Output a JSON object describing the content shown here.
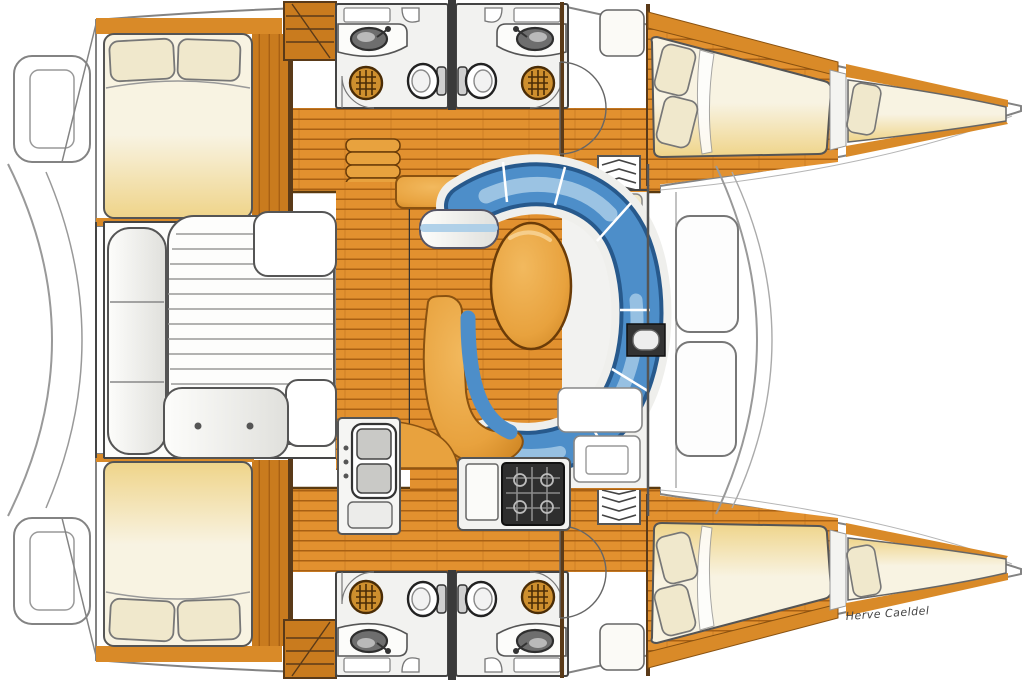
{
  "credit": {
    "artist_signature": "Herve Caeldel"
  },
  "palette": {
    "bg": "#FFFFFF",
    "wood_base": "#E2912F",
    "wood_gap": "#A86013",
    "wood_dark": "#C97B1E",
    "hull_wall": "#D98A28",
    "hull_wall_dark": "#8A5210",
    "wall_dark": "#4A3014",
    "outline": "#555555",
    "hull_stroke": "#838383",
    "bed_light": "#F8F3E2",
    "bed_gold": "#EFD489",
    "pillow": "#F0E8CC",
    "white_floor": "#F2F2F0",
    "bench_white": "#FDFDFB",
    "bench_shade": "#E0E0DC",
    "settee_blue": "#4D8EC9",
    "settee_dark": "#27598C",
    "settee_light": "#A9CDE8",
    "table_orange": "#E8A23E",
    "table_deep": "#C87E1C",
    "stove": "#2E2E2E",
    "basin": "#6E6E6E",
    "shower_drain": "#CE8F2E",
    "drain_grid": "#4A2C06",
    "signature": "#444444"
  },
  "features": {
    "hulls": [
      "port-hull",
      "starboard-hull"
    ],
    "cabins": [
      "aft-double-cabin-port",
      "aft-double-cabin-starboard",
      "forward-double-cabin-port",
      "forward-double-cabin-starboard",
      "forepeak-berth-port",
      "forepeak-berth-starboard"
    ],
    "bathrooms": {
      "count": 4,
      "fixtures": [
        "vanity-washbasin",
        "marine-toilet",
        "shower-drain",
        "corner-basin",
        "mirror-cabinet"
      ]
    },
    "salon": [
      "wraparound-settee",
      "oval-dining-table",
      "lounge-chaise",
      "side-bench",
      "sideboard",
      "chart-table",
      "storage-locker"
    ],
    "galley": [
      "double-sink",
      "front-opening-fridge",
      "burner-stove",
      "cutting-board",
      "curved-counter"
    ],
    "cockpit": [
      "aft-bench",
      "slatted-table-sunpad",
      "corner-seat",
      "forward-bench-with-buttons",
      "transom-bench"
    ],
    "deck": [
      "foredeck-hatch",
      "foredeck-hatch",
      "mast-step",
      "forward-crossbeam",
      "stern-platform",
      "companionway-steps",
      "hull-steps"
    ]
  }
}
